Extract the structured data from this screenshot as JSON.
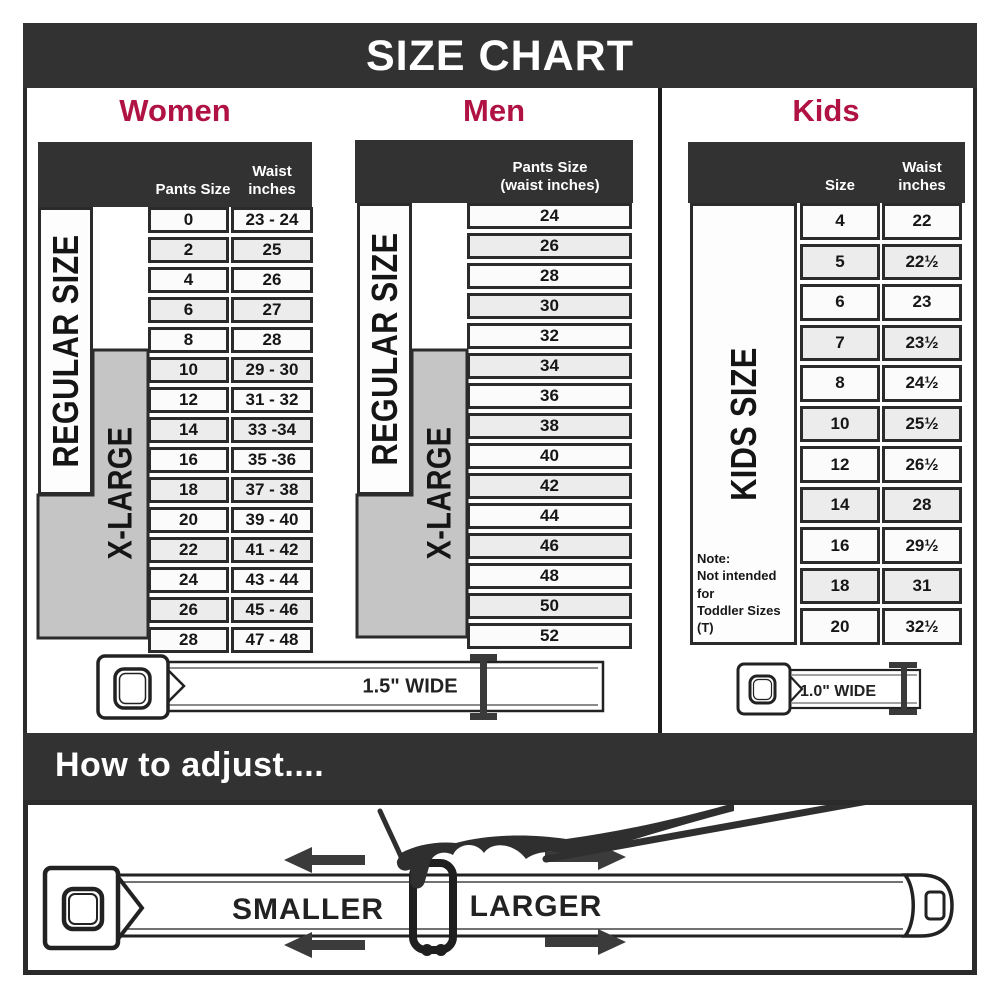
{
  "title": "SIZE CHART",
  "colors": {
    "accent": "#B01243",
    "bar": "#333233",
    "grid": "#2B2B2B",
    "gray_zone": "#C6C5C6",
    "row_alt": "#ECECEC"
  },
  "women": {
    "heading": "Women",
    "col1_header": "Pants Size",
    "col2_header": "Waist\ninches",
    "regular_label": "REGULAR SIZE",
    "xlarge_label": "X-LARGE",
    "rows": [
      {
        "size": "0",
        "waist": "23 - 24"
      },
      {
        "size": "2",
        "waist": "25"
      },
      {
        "size": "4",
        "waist": "26"
      },
      {
        "size": "6",
        "waist": "27"
      },
      {
        "size": "8",
        "waist": "28"
      },
      {
        "size": "10",
        "waist": "29 - 30"
      },
      {
        "size": "12",
        "waist": "31 - 32"
      },
      {
        "size": "14",
        "waist": "33 -34"
      },
      {
        "size": "16",
        "waist": "35 -36"
      },
      {
        "size": "18",
        "waist": "37 - 38"
      },
      {
        "size": "20",
        "waist": "39 - 40"
      },
      {
        "size": "22",
        "waist": "41 - 42"
      },
      {
        "size": "24",
        "waist": "43 - 44"
      },
      {
        "size": "26",
        "waist": "45 - 46"
      },
      {
        "size": "28",
        "waist": "47 - 48"
      }
    ],
    "belt_width_label": "1.5\" WIDE"
  },
  "men": {
    "heading": "Men",
    "col_header": "Pants Size\n(waist inches)",
    "regular_label": "REGULAR SIZE",
    "xlarge_label": "X-LARGE",
    "rows": [
      "24",
      "26",
      "28",
      "30",
      "32",
      "34",
      "36",
      "38",
      "40",
      "42",
      "44",
      "46",
      "48",
      "50",
      "52"
    ]
  },
  "kids": {
    "heading": "Kids",
    "col1_header": "Size",
    "col2_header": "Waist\ninches",
    "side_label": "KIDS SIZE",
    "note": "Note:\nNot intended for\nToddler Sizes (T)",
    "rows": [
      {
        "size": "4",
        "waist": "22"
      },
      {
        "size": "5",
        "waist": "22½"
      },
      {
        "size": "6",
        "waist": "23"
      },
      {
        "size": "7",
        "waist": "23½"
      },
      {
        "size": "8",
        "waist": "24½"
      },
      {
        "size": "10",
        "waist": "25½"
      },
      {
        "size": "12",
        "waist": "26½"
      },
      {
        "size": "14",
        "waist": "28"
      },
      {
        "size": "16",
        "waist": "29½"
      },
      {
        "size": "18",
        "waist": "31"
      },
      {
        "size": "20",
        "waist": "32½"
      }
    ],
    "belt_width_label": "1.0\" WIDE"
  },
  "adjust": {
    "heading": "How to adjust....",
    "smaller_label": "SMALLER",
    "larger_label": "LARGER"
  }
}
